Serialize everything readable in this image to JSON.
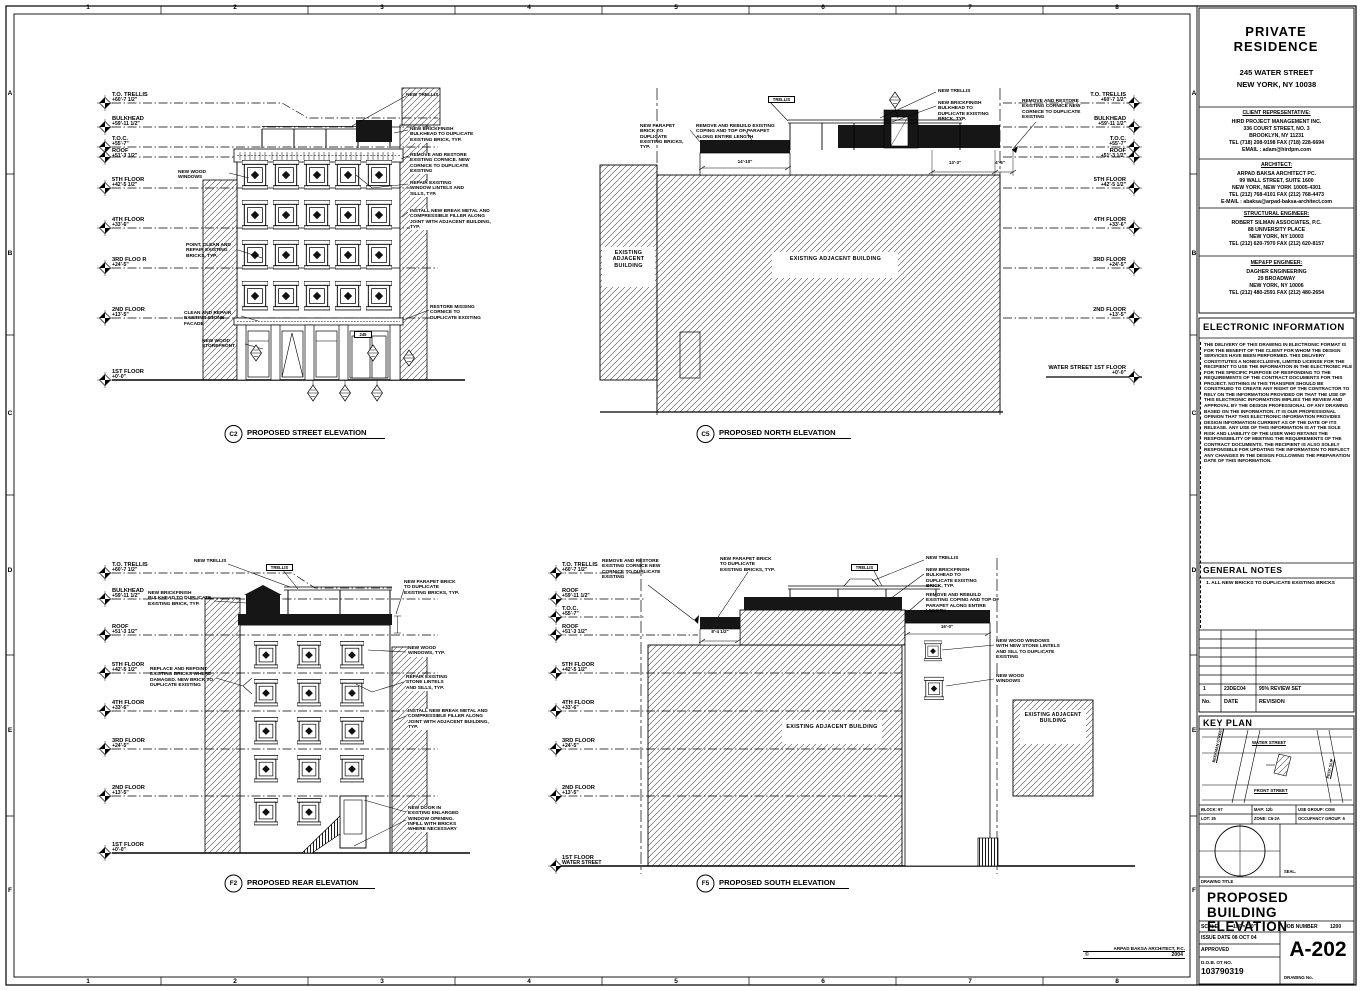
{
  "border": {
    "cols": [
      "1",
      "2",
      "3",
      "4",
      "5",
      "6",
      "7",
      "8"
    ],
    "rows": [
      "A",
      "B",
      "C",
      "D",
      "E",
      "F"
    ]
  },
  "copyright": {
    "firm": "ARPAD BAKSA ARCHITECT, P.C.",
    "sym": "©",
    "year": "2004"
  },
  "titleblock": {
    "project": {
      "name": "PRIVATE RESIDENCE",
      "address1": "245 WATER STREET",
      "address2": "NEW YORK, NY  10038"
    },
    "client": {
      "header": "CLIENT REPRESENTATIVE:",
      "lines": [
        "HIRD PROJECT MANAGEMENT INC.",
        "336 COURT STREET, NO. 3",
        "BROOKLYN, NY 11231",
        "TEL (718) 208-9198 FAX (718) 228-6694",
        "EMAIL : adam@hirdpm.com"
      ]
    },
    "architect": {
      "header": "ARCHITECT:",
      "lines": [
        "ARPAD BAKSA ARCHITECT PC.",
        "99 WALL STREET, SUITE 1600",
        "NEW YORK, NEW YORK 10005-4301",
        "TEL (212) 768-4101 FAX (212) 768-4473",
        "E-MAIL : abaksa@arpad-baksa-architect.com"
      ]
    },
    "structural": {
      "header": "STRUCTURAL ENGINEER:",
      "lines": [
        "ROBERT SILMAN ASSOCIATES, P.C.",
        "88 UNIVERSITY PLACE",
        "NEW YORK, NY 10003",
        "TEL (212) 620-7970 FAX (212) 620-8157"
      ]
    },
    "mep": {
      "header": "MEP&FP ENGINEER:",
      "lines": [
        "DAGHER ENGINEERING",
        "29 BROADWAY",
        "NEW YORK, NY  10006",
        "TEL (212) 480-2591 FAX (212) 480-2654"
      ]
    },
    "electronic": {
      "header": "ELECTRONIC INFORMATION",
      "body": "THE DELIVERY OF THIS DRAWING IN ELECTRONIC FORMAT IS FOR THE BENEFIT OF THE CLIENT FOR WHOM THE DESIGN SERVICES HAVE BEEN PERFORMED. THIS DELIVERY CONSTITUTES A NONEXCLUSIVE, LIMITED LICENSE FOR THE RECIPIENT TO USE THE INFORMATION IN THE ELECTRONIC FILE FOR THE SPECIFIC PURPOSE OF RESPONDING TO THE REQUIREMENTS OF THE CONTRACT DOCUMENTS FOR THIS PROJECT. NOTHING IN THIS TRANSFER SHOULD BE CONSTRUED TO CREATE ANY RIGHT OF THE CONTRACTOR TO RELY ON THE INFORMATION PROVIDED OR THAT THE USE OF THIS ELECTRONIC INFORMATION IMPLIES THE REVIEW AND APPROVAL BY THE DESIGN PROFESSIONAL OF ANY DRAWING BASED ON THE INFORMATION. IT IS OUR PROFESSIONAL OPINION THAT THIS ELECTRONIC INFORMATION PROVIDES DESIGN INFORMATION CURRENT AS OF THE DATE OF ITS RELEASE. ANY USE OF THIS INFORMATION IS AT THE SOLE RISK AND LIABILITY OF THE USER WHO RETAINS THE RESPONSIBILITY OF MEETING THE REQUIREMENTS OF THE CONTRACT DOCUMENTS. THE RECIPIENT IS ALSO SOLELY RESPONSIBLE FOR UPDATING THE INFORMATION TO REFLECT ANY CHANGES IN THE DESIGN FOLLOWING THE PREPARATION DATE OF THIS INFORMATION."
    },
    "general_notes": {
      "header": "GENERAL NOTES",
      "note": "1. ALL NEW BRICKS TO DUPLICATE EXISTING BRICKS"
    },
    "revisions": {
      "h_no": "No.",
      "h_date": "DATE",
      "h_rev": "REVISION",
      "no": "1",
      "date": "23DEC04",
      "desc": "95% REVIEW SET"
    },
    "keyplan": {
      "header": "KEY PLAN",
      "water": "WATER STREET",
      "front": "FRONT STREET",
      "beekman": "BEEKMAN STREET",
      "peck": "PECK SLIP",
      "block": "BLOCK: 97",
      "lot": "LOT: 35",
      "map": "MAP: 12b",
      "zone": "ZONE: C6-2A",
      "use": "USE GROUP: COM",
      "occ": "OCCUPANCY GROUP: 6",
      "seal": "SEAL."
    },
    "title_area": {
      "drawing_title_label": "DRAWING TITLE",
      "title": "PROPOSED BUILDING ELEVATION",
      "scale_label": "SCALE",
      "scale": "1/8\"=1'-0\"",
      "job_label": "JOB NUMBER",
      "job": "1200",
      "issue": "ISSUE DATE 08 OCT 04",
      "approved": "APPROVED",
      "dob_label": "D.O.B. OT NO.",
      "dob": "103790319",
      "sheet_no": "A-202",
      "sheet_no_label": "DRAWING No."
    }
  },
  "elev": {
    "c2": {
      "tag": "C2",
      "title": "PROPOSED STREET ELEVATION",
      "levels": [
        {
          "n": "T.O. TRELLIS",
          "e": "+60'-7 1/2\""
        },
        {
          "n": "BULKHEAD",
          "e": "+59'-11 1/2\""
        },
        {
          "n": "T.O.C.",
          "e": "+55'-7\""
        },
        {
          "n": "ROOF",
          "e": "+51'-3 1/2\""
        },
        {
          "n": "5TH FLOOR",
          "e": "+42'-5 1/2\""
        },
        {
          "n": "4TH FLOOR",
          "e": "+33'-6\""
        },
        {
          "n": "3RD FLOO R",
          "e": "+24'-5\""
        },
        {
          "n": "2ND FLOOR",
          "e": "+13'-5\""
        },
        {
          "n": "1ST FLOOR",
          "e": "+0'-0\""
        }
      ],
      "notes": {
        "new_trellis": "NEW TRELLIS",
        "bulkhead": "NEW BRICKFINISH BULKHEAD TO DUPLICATE EXISTING BRICK, TYP.",
        "cornice": "REMOVE AND RESTORE EXISTING CORNICE. NEW CORNICE TO DUPLICATE EXISTING",
        "lintels": "REPAIR EXISTING WINDOW LINTELS AND SILLS, TYP.",
        "break_metal": "INSTALL NEW BREAK METAL AND COMPRESSIBLE FILLER ALONG JOINT WITH ADJACENT BUILDING, TYP.",
        "windows": "NEW WOOD WINDOWS",
        "point_clean": "POINT, CLEAN AND REPAIR EXISTING BRICKS, TYP.",
        "stone": "CLEAN AND REPAIR EXISTING STONE FACADE",
        "storefront": "NEW WOOD STOREFRONT",
        "restore_cornice": "RESTORE MISSING CORNICE TO DUPLICATE EXISTING",
        "address": "245"
      }
    },
    "c5": {
      "tag": "C5",
      "title": "PROPOSED NORTH ELEVATION",
      "levels": [
        {
          "n": "T.O. TRELLIS",
          "e": "+60'-7 1/2\""
        },
        {
          "n": "BULKHEAD",
          "e": "+59'-11 1/2\""
        },
        {
          "n": "T.O.C.",
          "e": "+55'-7\""
        },
        {
          "n": "ROOF",
          "e": "+51'-3 1/2\""
        },
        {
          "n": "5TH FLOOR",
          "e": "+42'-5 1/2\""
        },
        {
          "n": "4TH FLOOR",
          "e": "+33'-6\""
        },
        {
          "n": "3RD FLOOR",
          "e": "+24'-5\""
        },
        {
          "n": "2ND FLOOR",
          "e": "+13'-5\""
        },
        {
          "n": "WATER STREET 1ST FLOOR",
          "e": "+0'-0\""
        }
      ],
      "notes": {
        "parapet": "NEW PARAPET BRICK TO DUPLICATE EXISTING BRICKS, TYP.",
        "coping": "REMOVE AND REBUILD EXISTING COPING AND TOP OF PARAPET ALONG ENTIRE LENGTH",
        "trellis": "TRELLIS",
        "new_trellis": "NEW TRELLIS",
        "bulkhead": "NEW BRICKFINISH BULKHEAD TO DUPLICATE EXISTING BRICK, TYP.",
        "cornice": "REMOVE AND RESTORE EXISTING CORNICE NEW CORNICE TO DUPLICATE EXISTING",
        "existing": "EXISTING ADJACENT BUILDING"
      },
      "dims": {
        "d1": "14'-10\"",
        "d2": "13'-3\"",
        "d3": "4'-5\""
      }
    },
    "f2": {
      "tag": "F2",
      "title": "PROPOSED REAR ELEVATION",
      "levels": [
        {
          "n": "T.O. TRELLIS",
          "e": "+60'-7 1/2\""
        },
        {
          "n": "BULKHEAD",
          "e": "+59'-11 1/2\""
        },
        {
          "n": "ROOF",
          "e": "+51'-3 1/2\""
        },
        {
          "n": "5TH FLOOR",
          "e": "+42'-5 1/2\""
        },
        {
          "n": "4TH FLOOR",
          "e": "+33'-6\""
        },
        {
          "n": "3RD FLOOR",
          "e": "+24'-5\""
        },
        {
          "n": "2ND FLOOR",
          "e": "+13'-5\""
        },
        {
          "n": "1ST FLOOR",
          "e": "+0'-0\""
        }
      ],
      "notes": {
        "new_trellis": "NEW TRELLIS",
        "trellis": "TRELLIS",
        "bulkhead": "NEW BRICKFINISH BULKHEAD TO DUPLICATE EXISTING BRICK, TYP.",
        "repoint": "REPLACE AND REPOINT EXISTING BRICKS WHERE DAMAGED. NEW BRICK TO DUPLICATE EXISTING",
        "parapet": "NEW PARAPET BRICK TO DUPLICATE EXISTING BRICKS, TYP.",
        "windows": "NEW WOOD WINDOWS, TYP.",
        "lintels": "REPAIR EXISTING STONE LINTELS AND SILLS, TYP.",
        "break_metal": "INSTALL NEW BREAK METAL AND COMPRESSIBLE FILLER ALONG JOINT WITH ADJACENT BUILDING, TYP.",
        "new_door": "NEW DOOR IN EXISTING ENLARGED WINDOW OPENING. INFILL WITH BRICKS WHERE NECESSARY"
      }
    },
    "f5": {
      "tag": "F5",
      "title": "PROPOSED SOUTH ELEVATION",
      "levels": [
        {
          "n": "T.O. TRELLIS",
          "e": "+60'-7 1/2\""
        },
        {
          "n": "ROOF",
          "e": "+59'-11 1/2\""
        },
        {
          "n": "T.O.C.",
          "e": "+55'-7\""
        },
        {
          "n": "ROOF",
          "e": "+51'-3 1/2\""
        },
        {
          "n": "5TH FLOOR",
          "e": "+42'-5 1/2\""
        },
        {
          "n": "4TH FLOOR",
          "e": "+33'-6\""
        },
        {
          "n": "3RD FLOOR",
          "e": "+24'-5\""
        },
        {
          "n": "2ND FLOOR",
          "e": "+13'-5\""
        },
        {
          "n": "1ST FLOOR",
          "e": "WATER STREET"
        }
      ],
      "notes": {
        "cornice": "REMOVE AND RESTORE EXISTING CORNICE NEW CORNICE TO DUPLICATE EXISTING",
        "parapet": "NEW PARAPET BRICK TO DUPLICATE EXISTING BRICKS, TYP.",
        "trellis": "TRELLIS",
        "new_trellis": "NEW TRELLIS",
        "bulkhead": "NEW BRICKFINISH BULKHEAD TO DUPLICATE EXISTING BRICK, TYP.",
        "coping": "REMOVE AND REBUILD EXISTING COPING AND TOP OF PARAPET ALONG ENTIRE LENGTH",
        "windows_stone": "NEW WOOD WINDOWS WITH NEW STONE LINTELS AND SILL TO DUPLICATE EXISTING",
        "windows": "NEW WOOD WINDOWS",
        "existing": "EXISTING ADJACENT BUILDING"
      },
      "dims": {
        "d1": "8'-4 1/2\"",
        "d2": "16'-0\""
      }
    }
  }
}
